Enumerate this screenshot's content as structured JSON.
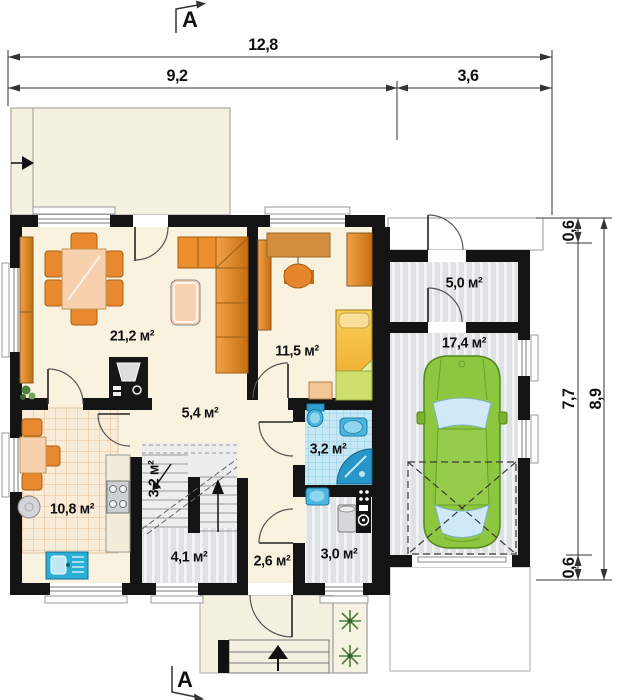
{
  "sections": {
    "top": "A",
    "bottom": "A"
  },
  "dimensions": {
    "total_width": "12,8",
    "main_width": "9,2",
    "garage_width": "3,6",
    "top_offset": "0,6",
    "inner_height": "7,7",
    "bottom_offset": "0,6",
    "total_height": "8,9"
  },
  "rooms": {
    "living": "21,2 м²",
    "bedroom": "11,5 м²",
    "storage": "5,0 м²",
    "garage": "17,4 м²",
    "hall": "5,4 м²",
    "stairs": "3,2 м²",
    "kitchen": "10,8 м²",
    "vestibule": "4,1 м²",
    "entry": "2,6 м²",
    "utility": "3,0 м²",
    "bathroom": "3,2 м²"
  },
  "colors": {
    "wall": "#141414",
    "floor_cream": "#f9f2df",
    "terrace": "#f5f1e0",
    "furniture_orange": "#e8882f",
    "table_peach": "#f7d0ad",
    "bed_yellow": "#f3b93c",
    "blanket_green": "#cfdf6e",
    "car_green": "#8dc63f",
    "sanitary_blue": "#4ab5df",
    "bath_tile": "#c6e8f5",
    "kitchen_tile": "#f9ecd9",
    "garage_floor": "#dfe2e4"
  }
}
